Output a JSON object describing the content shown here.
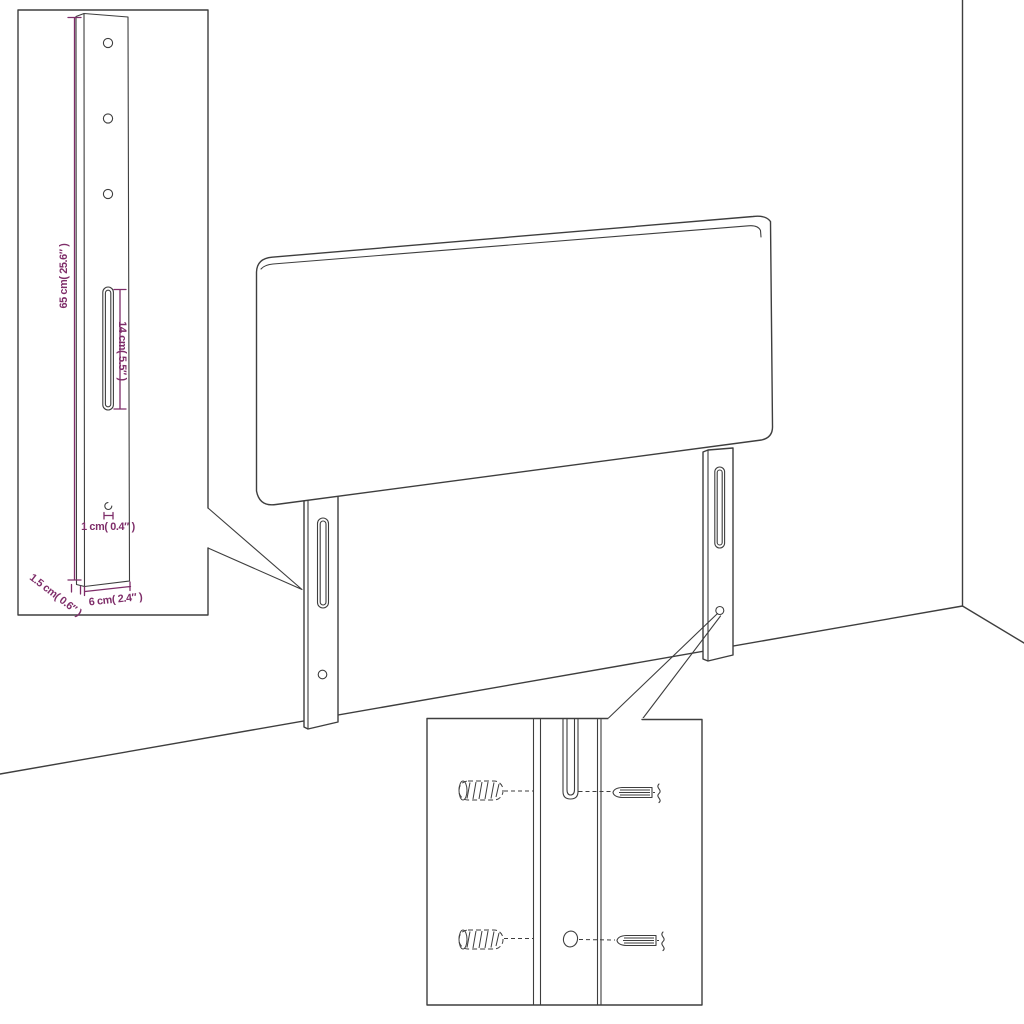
{
  "diagram": {
    "background": "#ffffff",
    "line_color": "#3e3e3e",
    "dimension_color": "#7e2d69"
  },
  "annotations": {
    "leg_height": "65 cm( 25.6″ )",
    "slot_length": "14 cm( 5.5″ )",
    "hole_diameter": "1 cm( 0.4″ )",
    "leg_thickness": "1.5 cm( 0.6″ )",
    "leg_width": "6 cm( 2.4″ )"
  }
}
